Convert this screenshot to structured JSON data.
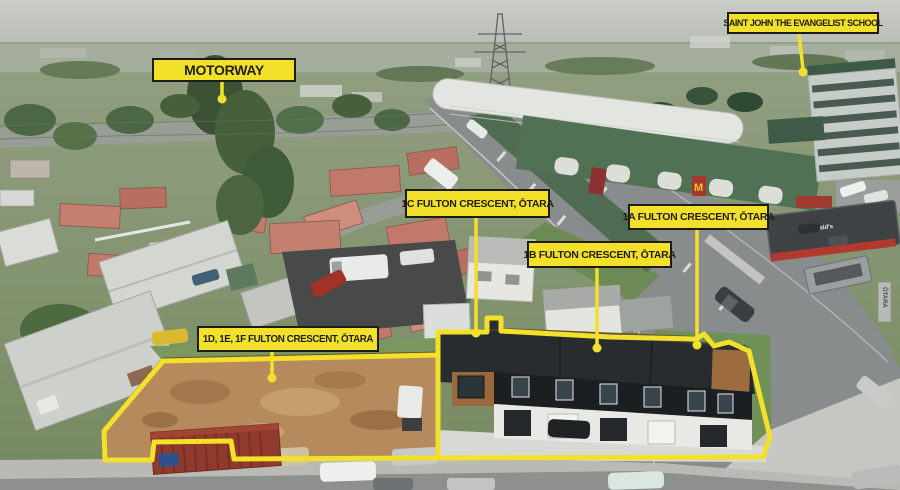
{
  "labels": {
    "motorway": "MOTORWAY",
    "school": "SAINT JOHN THE EVANGELIST SCHOOL",
    "unit_1c": "1C FULTON CRESCENT, ŌTARA",
    "unit_1b": "1B FULTON CRESCENT, ŌTARA",
    "unit_1a": "1A FULTON CRESCENT, ŌTARA",
    "units_1def": "1D, 1E, 1F FULTON CRESCENT, ŌTARA"
  },
  "scene": {
    "mcdonalds_sign": "McDonald's",
    "mcdonalds_m": "M",
    "road_pillar_text": "ŌTARA"
  },
  "colors": {
    "annotation_yellow": "#F2E02B",
    "annotation_border": "#1C1C14",
    "annotation_text": "#201F16"
  }
}
